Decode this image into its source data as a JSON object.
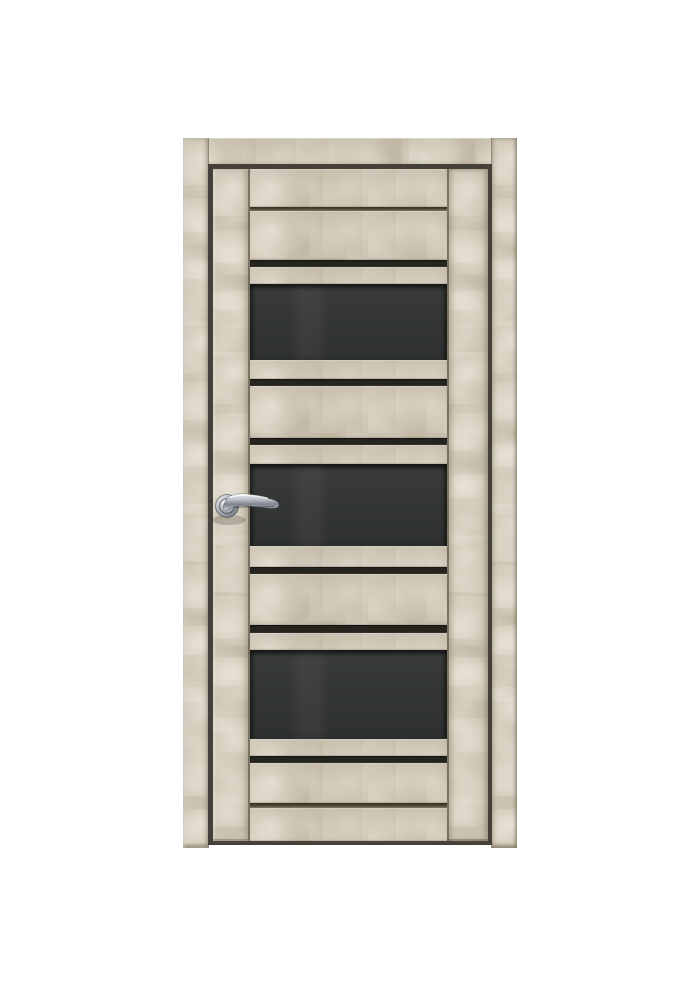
{
  "scene": {
    "type": "product photo",
    "subject": "Interior door with casing frame, front view, light beige concrete-textured finish with three dark glass inserts and black accent stripes, chrome lever handle on the left",
    "background_color": "#ffffff"
  },
  "door": {
    "finish": "light beige stone / loft concrete texture",
    "glass_panel_count": 3,
    "accent_stripe_count": 6,
    "groove_count": 2,
    "handle": {
      "style": "lever handle on round rosette",
      "finish": "polished chrome",
      "position": "left side, mid-height"
    },
    "colors": {
      "finish_beige": "#ccc4b3",
      "finish_light": "#dad3c4",
      "finish_dark": "#b3aa97",
      "glass_charcoal": "#343735",
      "stripe_black": "#25241f",
      "groove_brown": "#584e3f",
      "reveal_gap": "#45403a",
      "chrome_light": "#eef1f3",
      "chrome_dark": "#6b7076",
      "background": "#ffffff"
    }
  }
}
